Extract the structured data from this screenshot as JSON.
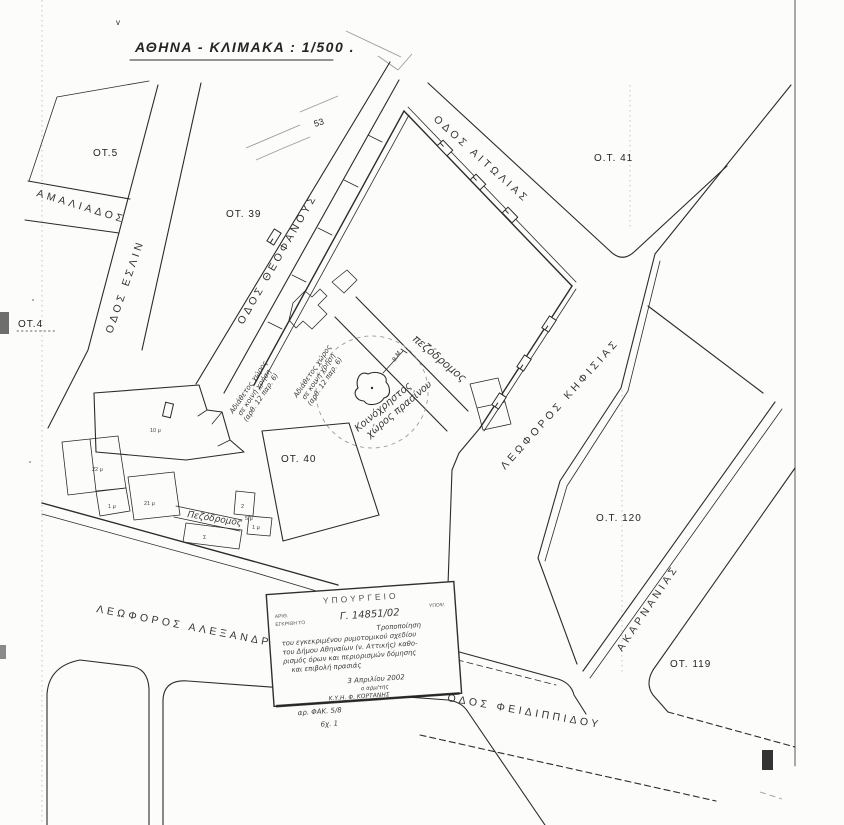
{
  "title": "ΑΘΗΝΑ - ΚΛΙΜΑΚΑ : 1/500 .",
  "marks": {
    "check": "v",
    "pencil_number": "53"
  },
  "blocks": {
    "ot5": "ΟΤ.5",
    "ot4": "ΟΤ.4",
    "ot39": "ΟΤ. 39",
    "ot40": "ΟΤ. 40",
    "ot41": "Ο.Τ. 41",
    "ot119": "ΟΤ. 119",
    "ot120": "Ο.Τ. 120"
  },
  "streets": {
    "amaliados": "ΑΜΑΛΙΑΔΟΣ",
    "eslin": "ΟΔΟΣ ΕΣΛΙΝ",
    "theofanous": "ΟΔΟΣ ΘΕΟΦΑΝΟΥΣ",
    "aitolias": "ΟΔΟΣ ΑΙΤΩΛΙΑΣ",
    "kifisias": "ΛΕΩΦΟΡΟΣ ΚΗΦΙΣΙΑΣ",
    "alexandras": "ΛΕΩΦΟΡΟΣ  ΑΛΕΞΑΝΔΡΑΣ",
    "akarnanias": "ΑΚΑΡΝΑΝΙΑΣ",
    "feidippidou": "ΟΔΟΣ  ΦΕΙΔΙΠΠΙΔΟΥ"
  },
  "annotations": {
    "adiathetos": {
      "l1": "Αδιάθετος χώρος",
      "l2": "σε κοινή χρήση",
      "l3": "(αρθ. 12 παρ. 6)"
    },
    "pezodromos_diag": "πεζόδρομος",
    "pezodromos_strip": "Πεζόδρομος",
    "green_l1": "Κοινόχρηστος",
    "green_l2": "χώρος πρασίνου",
    "tree_mark": "8.Μ"
  },
  "parcel_labels": {
    "p10": "10 μ",
    "p22": "22 μ",
    "p21": "21 μ",
    "p1a": "1 μ",
    "p1b": "1 μ",
    "p2": "2",
    "p5": "5 μ",
    "sigma": "Σ"
  },
  "stamp": {
    "ministry": "ΥΠΟΥΡΓΕΙΟ",
    "small_left1": "ΑΡΙΘ.",
    "small_left2": "ΕΓΚΡΙΘΗ ΤΟ",
    "small_right": "ΥΠΟΨ.",
    "protocol": "Γ. 14851/02",
    "body_l1": "Τροποποίηση",
    "body_l2": "του εγκεκριμένου ρυμοτομικού σχεδίου",
    "body_l3": "του Δήμου Αθηναίων (ν. Αττικής) καθο-",
    "body_l4": "ρισμός όρων και περιορισμών δόμησης",
    "body_l5": "και επιβολή πρασιάς",
    "date": "3 Απριλίου 2002",
    "signer": "ο αρμ/της",
    "signature": "Κ.Υ.Η.  Φ. ΚΟΡΤΑΝΗΣ",
    "file_no": "αρ. ΦΑΚ. 5/8",
    "sheet": "6χ. 1"
  },
  "colors": {
    "ink": "#2b2b2b",
    "pencil": "#9b9b9b",
    "paper": "#fcfcfa"
  }
}
